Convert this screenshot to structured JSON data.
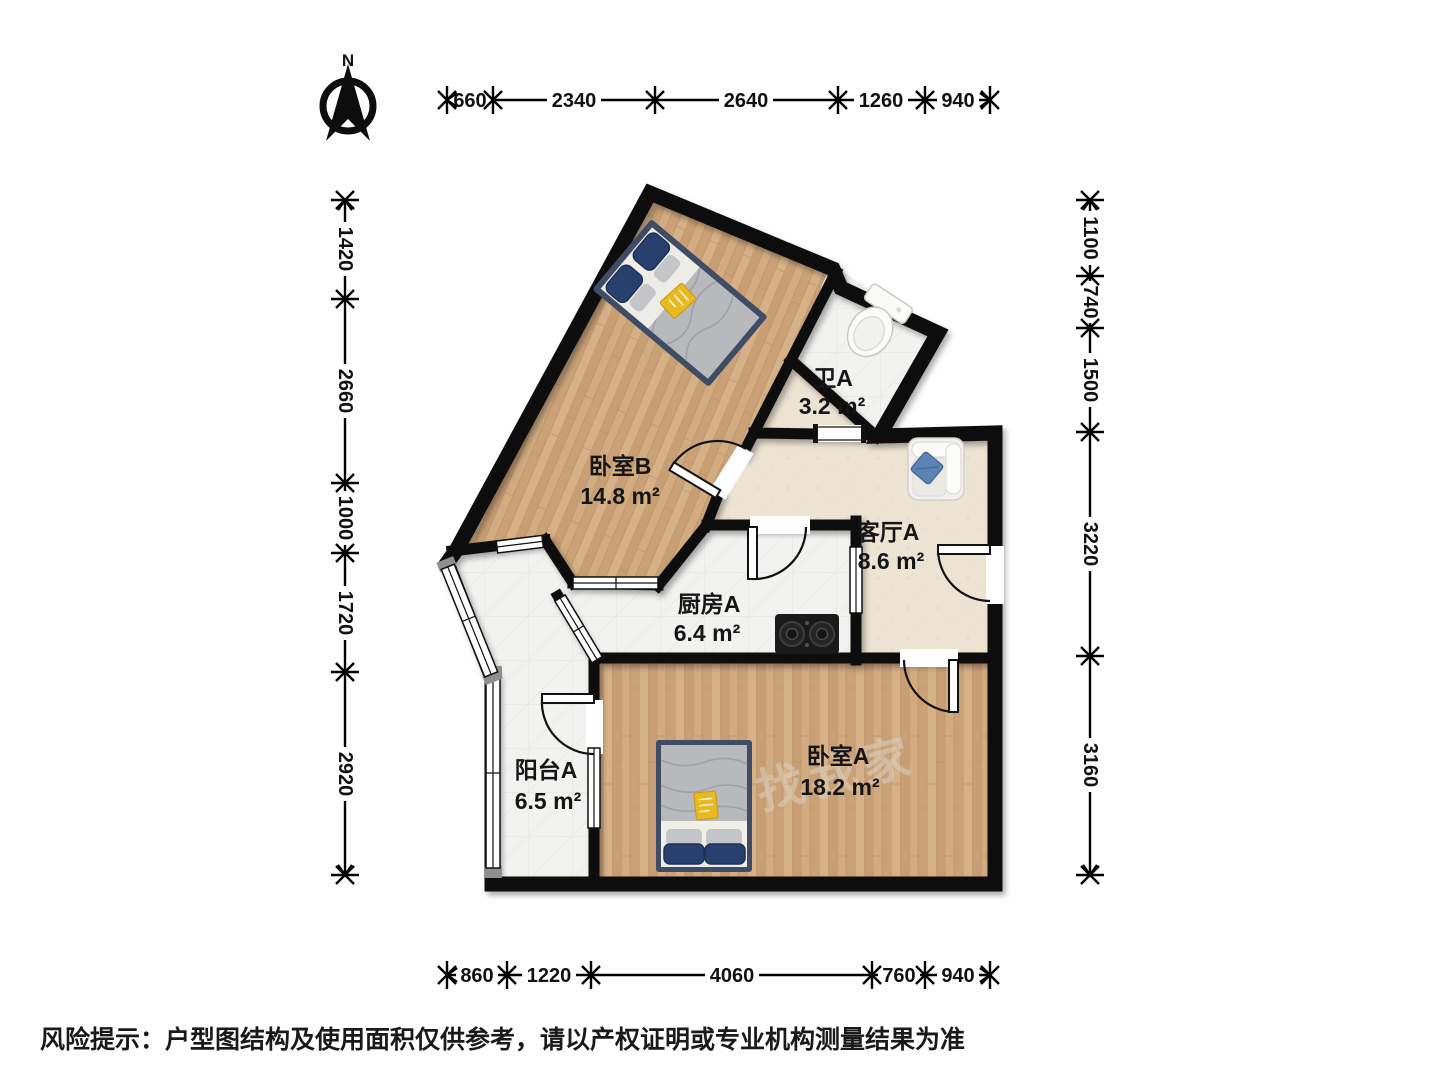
{
  "north": {
    "label": "N"
  },
  "rooms": {
    "bedroom_b": {
      "name": "卧室B",
      "area": "14.8 m²"
    },
    "bath_a": {
      "name": "卫A",
      "area": "3.2 m²"
    },
    "living_a": {
      "name": "客厅A",
      "area": "8.6 m²"
    },
    "kitchen_a": {
      "name": "厨房A",
      "area": "6.4 m²"
    },
    "bedroom_a": {
      "name": "卧室A",
      "area": "18.2 m²"
    },
    "balcony_a": {
      "name": "阳台A",
      "area": "6.5 m²"
    }
  },
  "dims": {
    "top": [
      "660",
      "2340",
      "2640",
      "1260",
      "940"
    ],
    "bottom": [
      "860",
      "1220",
      "4060",
      "760",
      "940"
    ],
    "left": [
      "1420",
      "2660",
      "1000",
      "1720",
      "2920"
    ],
    "right": [
      "1100",
      "740",
      "1500",
      "3220",
      "3160"
    ]
  },
  "disclaimer": "风险提示：户型图结构及使用面积仅供参考，请以产权证明或专业机构测量结果为准",
  "watermark": "找我家",
  "colors": {
    "wall": "#0d0d0d",
    "wood": "#cda47b",
    "tile": "#f2f2f0",
    "beige": "#ece3d3",
    "pillow_navy": "#28406e",
    "blanket_gray": "#b7b9bd",
    "book_yellow": "#e9b91f",
    "sofa_pillow_blue": "#5b84b3"
  }
}
